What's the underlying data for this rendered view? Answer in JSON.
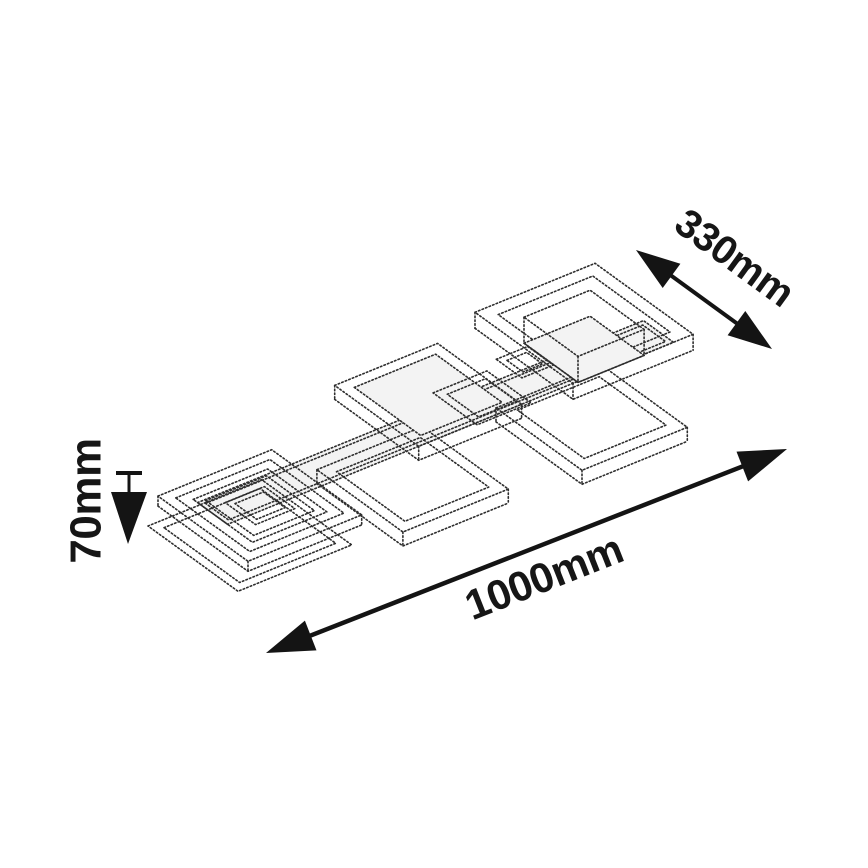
{
  "dimensions": {
    "width": "330mm",
    "length": "1000mm",
    "height": "70mm"
  },
  "colors": {
    "ink": "#161616",
    "drawing_line": "#2e2e2e",
    "background": "#ffffff"
  }
}
